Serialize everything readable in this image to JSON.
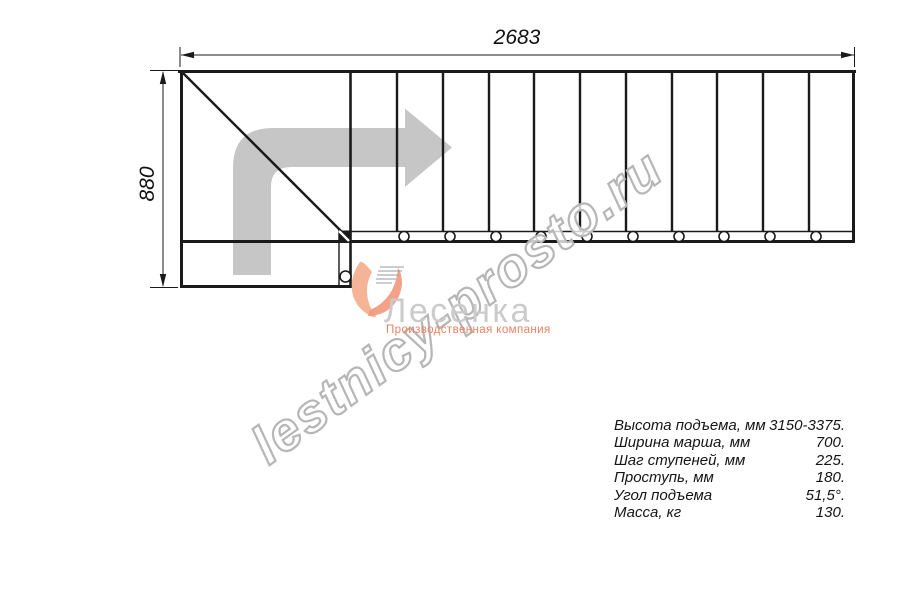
{
  "drawing": {
    "title_dimension_top": "2683",
    "title_dimension_left": "880",
    "description": "staircase-plan-top-view",
    "tread_count": 11,
    "colors": {
      "line": "#1a1a1a",
      "arrow_gray": "#c6c6c6",
      "watermark_gray": "#b6b6b6",
      "logo_gray": "#cbcbcb",
      "logo_salmon": "#ef8a68"
    }
  },
  "watermark": {
    "text": "lestnicy-prosto.ru"
  },
  "logo": {
    "name": "Лесенка",
    "tagline": "Производственная компания"
  },
  "specs": {
    "rows": [
      {
        "label": "Высота подъема, мм",
        "value": "3150-3375."
      },
      {
        "label": "Ширина марша, мм",
        "value": "700."
      },
      {
        "label": "Шаг ступеней, мм",
        "value": "225."
      },
      {
        "label": "Проступь, мм",
        "value": "180."
      },
      {
        "label": "Угол подъема",
        "value": "51,5°."
      },
      {
        "label": "Масса, кг",
        "value": "130."
      }
    ]
  }
}
